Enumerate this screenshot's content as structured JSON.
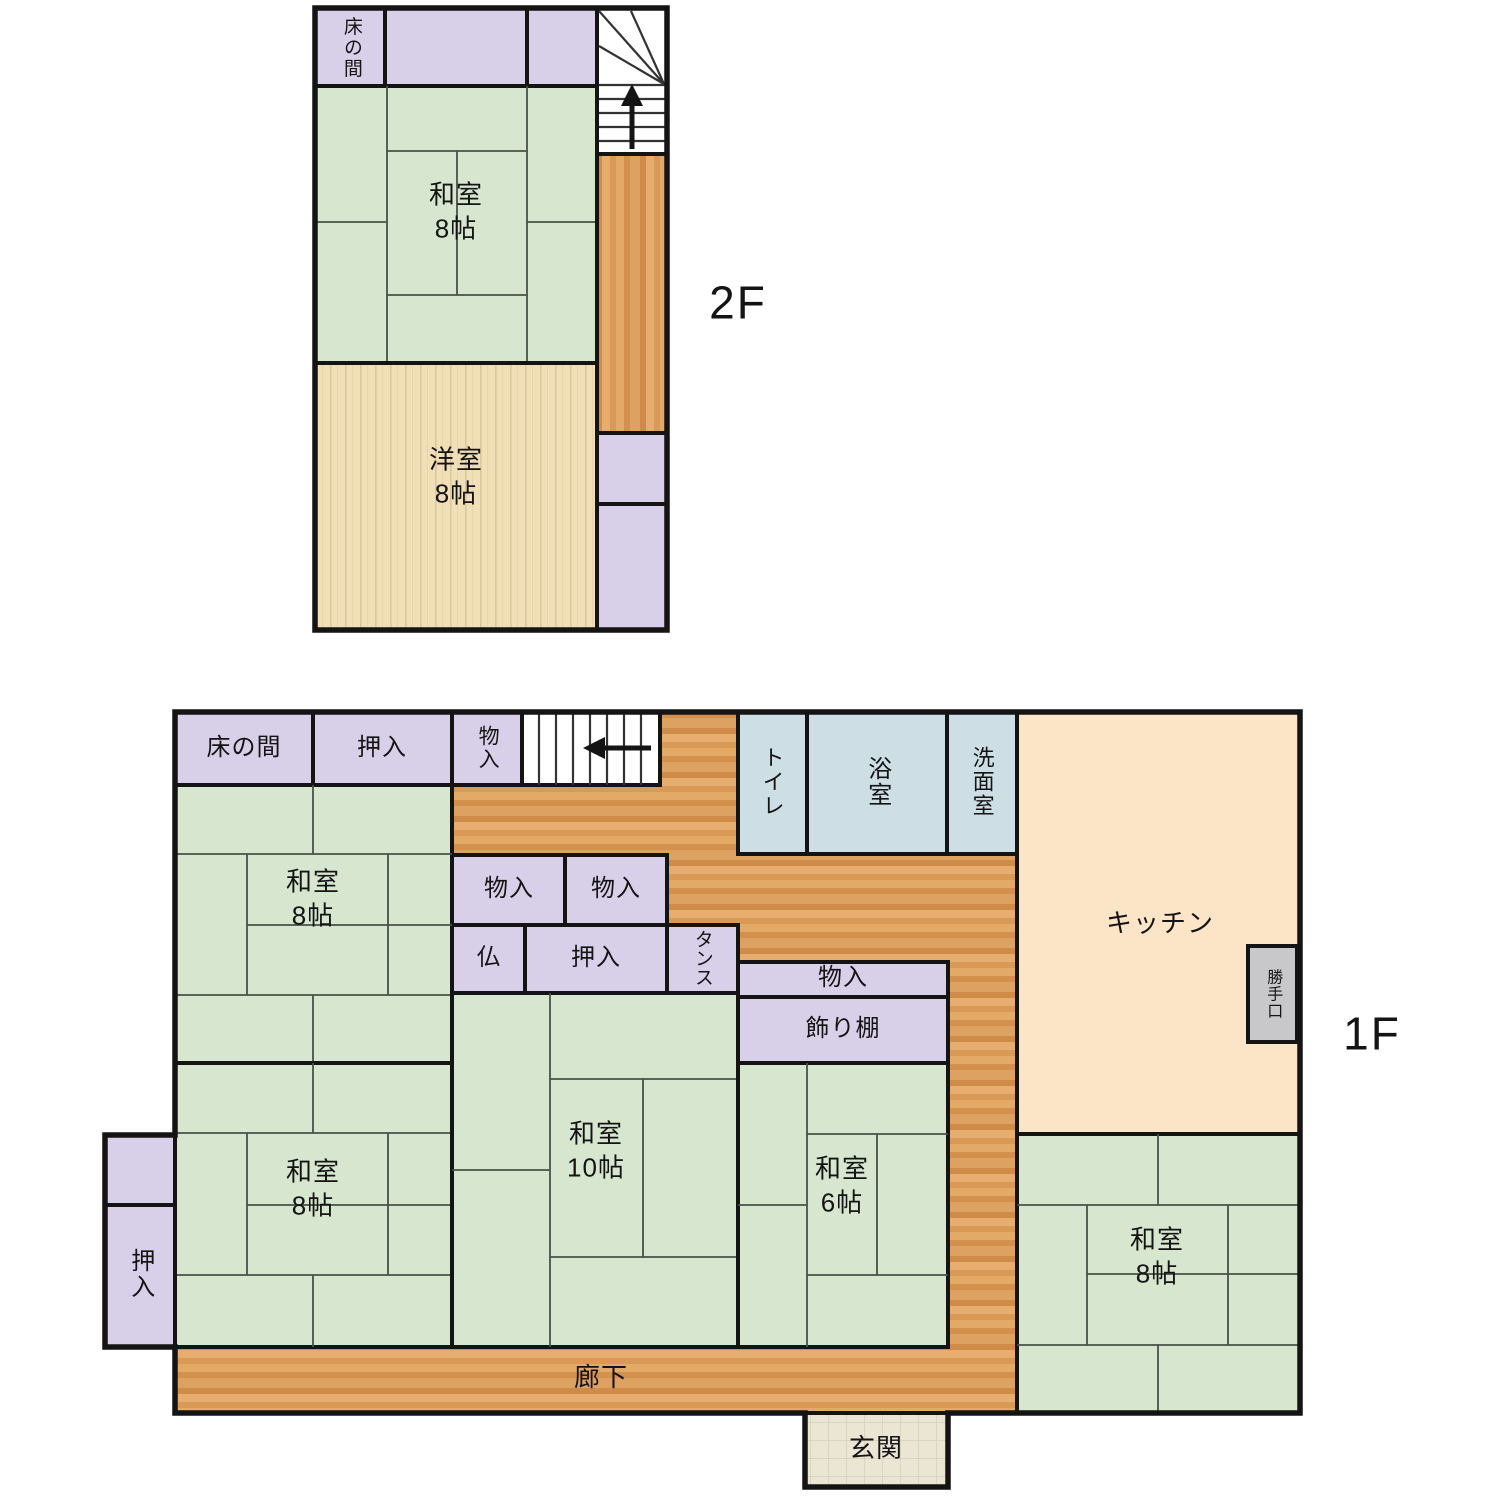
{
  "title": "間取り図",
  "floor2": {
    "floor_label": "2F",
    "tokonoma": "床の間",
    "washitsu": {
      "name": "和室",
      "size": "8帖"
    },
    "youshitsu": {
      "name": "洋室",
      "size": "8帖"
    }
  },
  "floor1": {
    "floor_label": "1F",
    "tokonoma": "床の間",
    "oshiire_top": "押入",
    "monoiri_top": "物入",
    "toilet": "トイレ",
    "bathroom": "浴室",
    "washroom": "洗面室",
    "kitchen": "キッチン",
    "back_door": "勝手口",
    "monoiri_a": "物入",
    "monoiri_b": "物入",
    "butsudan": "仏",
    "oshiire_mid": "押入",
    "tansu": "タンス",
    "monoiri_center": "物入",
    "kazaridana": "飾り棚",
    "oshiire_left": "押入",
    "washitsu_tl": {
      "name": "和室",
      "size": "8帖"
    },
    "washitsu_bl": {
      "name": "和室",
      "size": "8帖"
    },
    "washitsu_ten": {
      "name": "和室",
      "size": "10帖"
    },
    "washitsu_six": {
      "name": "和室",
      "size": "6帖"
    },
    "washitsu_br": {
      "name": "和室",
      "size": "8帖"
    },
    "rouka": "廊下",
    "genkan": "玄関"
  },
  "palette": {
    "tatami_green": "#d7e7cf",
    "closet_purple": "#d8cfe9",
    "bath_blue": "#cddfe4",
    "kitchen_peach": "#fce4c7",
    "corridor_wood": "#dca05e",
    "plank_wood": "#f1dfb8",
    "genkan_tile": "#ebe5d3",
    "back_door_gray": "#c8c8ca",
    "wall_black": "#141414"
  }
}
